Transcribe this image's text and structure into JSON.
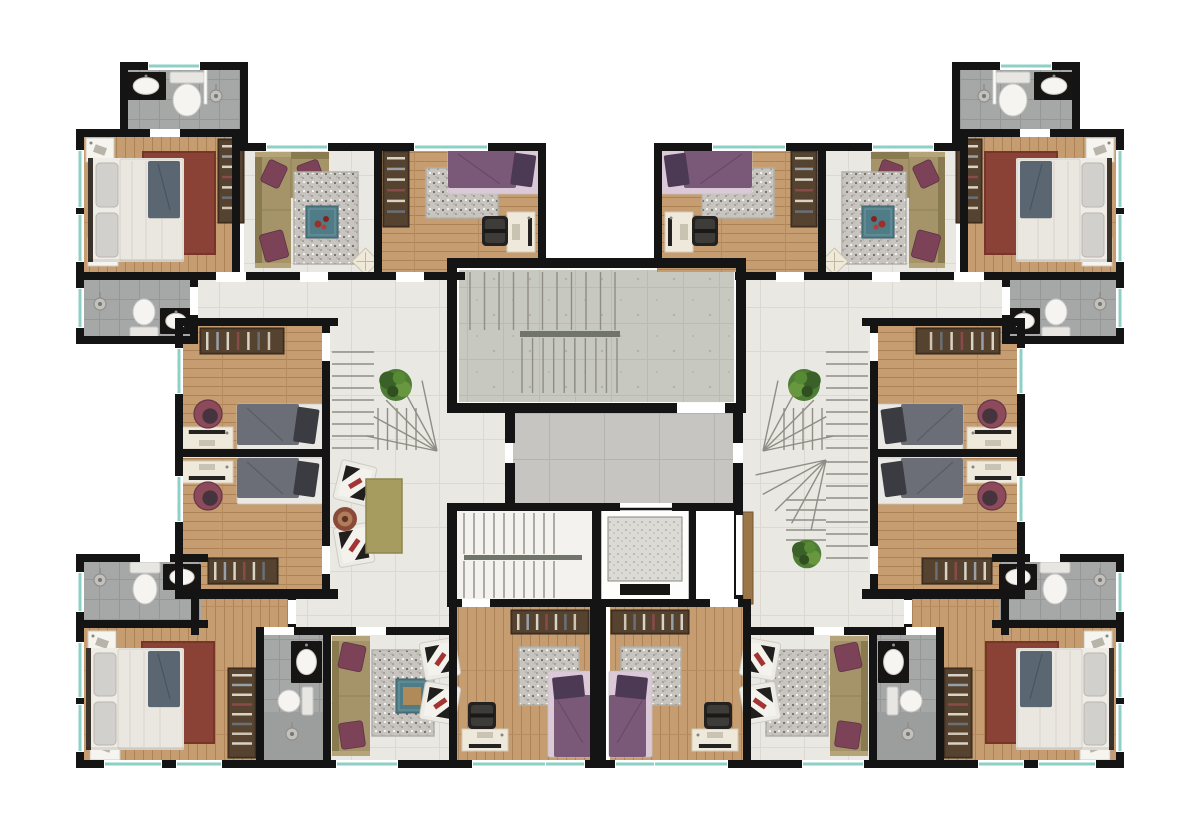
{
  "meta": {
    "label": "Residential apartment building floor plan, top view, symmetric left and right wings with central stairwell and elevator"
  },
  "palette": {
    "wall": "#141414",
    "gap": "#ffffff",
    "teal": "#8fd0c6",
    "stairLine": "#8f8d84",
    "rail": "#70746a",
    "headboard": "#3a332b",
    "sofa": "#a5946a",
    "sofaDark": "#8a7a4f",
    "cushion": "#7c4257",
    "rugRed": "#8a4136",
    "rugRedEdge": "#763528",
    "rugGreen": "#a69c60",
    "rugGrayEdge": "#b2afa8",
    "wardrobe": "#4d3b2c",
    "desk": "#efe9dc",
    "fixture": "#f5f4f1"
  },
  "floors": [
    {
      "n": "hall-left",
      "x": 183,
      "y": 272,
      "w": 274,
      "h": 328,
      "p": "tile",
      "m": 1
    },
    {
      "n": "hall-lobby-side",
      "x": 457,
      "y": 408,
      "w": 48,
      "h": 95,
      "p": "tile",
      "m": 0
    },
    {
      "n": "hall-bottom",
      "x": 285,
      "y": 595,
      "w": 172,
      "h": 40,
      "p": "tile",
      "m": 1
    },
    {
      "n": "living-top",
      "x": 244,
      "y": 149,
      "w": 136,
      "h": 123,
      "p": "tile",
      "m": 1
    },
    {
      "n": "living-bottom",
      "x": 288,
      "y": 635,
      "w": 161,
      "h": 127,
      "p": "tile",
      "m": 1
    },
    {
      "n": "entry-nook",
      "x": 199,
      "y": 597,
      "w": 89,
      "h": 30,
      "p": "woodV",
      "m": 1
    },
    {
      "n": "master-bedroom-top",
      "x": 82,
      "y": 133,
      "w": 156,
      "h": 139,
      "p": "woodV",
      "m": 1
    },
    {
      "n": "bedroom-top",
      "x": 382,
      "y": 147,
      "w": 161,
      "h": 125,
      "p": "woodH",
      "m": 1
    },
    {
      "n": "bedroom-mid-upper",
      "x": 183,
      "y": 326,
      "w": 140,
      "h": 126,
      "p": "woodH",
      "m": 1
    },
    {
      "n": "bedroom-mid-lower",
      "x": 183,
      "y": 458,
      "w": 140,
      "h": 133,
      "p": "woodH",
      "m": 1
    },
    {
      "n": "master-bedroom-bottom",
      "x": 84,
      "y": 627,
      "w": 176,
      "h": 135,
      "p": "woodV",
      "m": 1
    },
    {
      "n": "bedroom-bottom",
      "x": 457,
      "y": 607,
      "w": 133,
      "h": 155,
      "p": "woodV",
      "m": 1
    },
    {
      "n": "bathroom-top",
      "x": 128,
      "y": 70,
      "w": 112,
      "h": 61,
      "p": "bath",
      "m": 1
    },
    {
      "n": "bathroom-mid",
      "x": 84,
      "y": 280,
      "w": 106,
      "h": 58,
      "p": "bath",
      "m": 1
    },
    {
      "n": "bathroom-lower",
      "x": 84,
      "y": 562,
      "w": 117,
      "h": 58,
      "p": "bath",
      "m": 1
    },
    {
      "n": "bathroom-small",
      "x": 264,
      "y": 635,
      "w": 59,
      "h": 125,
      "p": "bath",
      "m": 1
    },
    {
      "n": "shower-floor",
      "x": 264,
      "y": 712,
      "w": 59,
      "h": 48,
      "f": "#9c9e9d",
      "m": 1
    },
    {
      "n": "stairwell-trim",
      "x": 452,
      "y": 263,
      "w": 289,
      "h": 146,
      "f": "#fbfbf9",
      "m": 0
    },
    {
      "n": "stairwell-concrete",
      "x": 459,
      "y": 270,
      "w": 275,
      "h": 132,
      "p": "conc",
      "m": 0
    },
    {
      "n": "elevator-lobby",
      "x": 513,
      "y": 411,
      "w": 220,
      "h": 92,
      "p": "lobbyP",
      "m": 0
    },
    {
      "n": "stair-core-floor",
      "x": 457,
      "y": 511,
      "w": 135,
      "h": 88,
      "f": "#f3f2ee",
      "m": 0
    }
  ],
  "walls": [
    [
      120,
      62,
      128,
      8,
      1
    ],
    [
      120,
      62,
      8,
      75,
      1
    ],
    [
      240,
      62,
      8,
      89,
      1
    ],
    [
      76,
      129,
      172,
      8,
      1
    ],
    [
      76,
      129,
      8,
      212,
      1
    ],
    [
      232,
      133,
      8,
      144,
      1
    ],
    [
      240,
      143,
      306,
      8,
      1
    ],
    [
      538,
      143,
      8,
      125,
      1
    ],
    [
      76,
      272,
      389,
      8,
      1
    ],
    [
      374,
      149,
      8,
      131,
      1
    ],
    [
      76,
      336,
      122,
      8,
      1
    ],
    [
      190,
      277,
      8,
      67,
      1
    ],
    [
      175,
      318,
      163,
      8,
      1
    ],
    [
      175,
      318,
      8,
      281,
      1
    ],
    [
      322,
      318,
      8,
      281,
      1
    ],
    [
      175,
      449,
      155,
      8,
      1
    ],
    [
      175,
      589,
      163,
      10,
      1
    ],
    [
      191,
      597,
      8,
      38,
      1
    ],
    [
      288,
      597,
      8,
      38,
      1
    ],
    [
      76,
      554,
      132,
      8,
      1
    ],
    [
      76,
      554,
      8,
      214,
      1
    ],
    [
      76,
      620,
      132,
      8,
      1
    ],
    [
      76,
      760,
      380,
      8,
      1
    ],
    [
      256,
      627,
      8,
      141,
      1
    ],
    [
      285,
      627,
      172,
      8,
      1
    ],
    [
      323,
      627,
      8,
      135,
      1
    ],
    [
      449,
      599,
      8,
      169,
      1
    ],
    [
      449,
      599,
      148,
      8,
      1
    ],
    [
      447,
      258,
      299,
      10,
      0
    ],
    [
      447,
      258,
      10,
      155,
      0
    ],
    [
      736,
      258,
      10,
      155,
      0
    ],
    [
      447,
      403,
      230,
      10,
      0
    ],
    [
      725,
      403,
      21,
      10,
      0
    ],
    [
      505,
      413,
      10,
      30,
      0
    ],
    [
      505,
      463,
      10,
      42,
      0
    ],
    [
      733,
      413,
      10,
      30,
      0
    ],
    [
      733,
      463,
      10,
      42,
      0
    ],
    [
      592,
      503,
      8,
      104,
      0
    ],
    [
      600,
      503,
      20,
      8,
      0
    ],
    [
      672,
      503,
      63,
      8,
      0
    ],
    [
      735,
      503,
      8,
      12,
      0
    ],
    [
      735,
      595,
      8,
      12,
      0
    ],
    [
      592,
      599,
      151,
      8,
      0
    ],
    [
      690,
      509,
      5,
      92,
      0
    ],
    [
      447,
      503,
      10,
      104,
      0
    ],
    [
      447,
      503,
      145,
      8,
      0
    ],
    [
      590,
      599,
      16,
      169,
      0
    ],
    [
      449,
      760,
      302,
      8,
      0
    ]
  ],
  "gaps": [
    [
      150,
      129,
      30,
      8,
      1
    ],
    [
      216,
      272,
      30,
      10,
      1
    ],
    [
      300,
      272,
      28,
      10,
      1
    ],
    [
      396,
      272,
      28,
      10,
      1
    ],
    [
      190,
      287,
      8,
      28,
      1
    ],
    [
      322,
      333,
      8,
      28,
      1
    ],
    [
      322,
      546,
      8,
      28,
      1
    ],
    [
      140,
      554,
      30,
      8,
      1
    ],
    [
      268,
      627,
      26,
      8,
      1
    ],
    [
      356,
      627,
      30,
      8,
      1
    ],
    [
      462,
      599,
      28,
      8,
      1
    ],
    [
      288,
      600,
      8,
      24,
      1
    ],
    [
      677,
      403,
      48,
      10,
      0
    ]
  ],
  "windows": [
    [
      148,
      62,
      52,
      8,
      1
    ],
    [
      76,
      150,
      8,
      58,
      1
    ],
    [
      76,
      214,
      8,
      48,
      1
    ],
    [
      76,
      288,
      8,
      40,
      1
    ],
    [
      175,
      348,
      8,
      46,
      1
    ],
    [
      175,
      476,
      8,
      46,
      1
    ],
    [
      76,
      572,
      8,
      40,
      1
    ],
    [
      76,
      642,
      8,
      56,
      1
    ],
    [
      76,
      704,
      8,
      48,
      1
    ],
    [
      104,
      760,
      58,
      8,
      1
    ],
    [
      176,
      760,
      46,
      8,
      1
    ],
    [
      336,
      760,
      62,
      8,
      1
    ],
    [
      472,
      760,
      74,
      8,
      1
    ],
    [
      545,
      760,
      40,
      8,
      1
    ],
    [
      266,
      143,
      62,
      8,
      1
    ],
    [
      414,
      143,
      74,
      8,
      1
    ]
  ],
  "stairs": [
    {
      "t": "run",
      "x": 470,
      "y": 272,
      "w": 145,
      "h": 58,
      "dir": "v",
      "n": 10,
      "m": 0
    },
    {
      "t": "rail",
      "x": 520,
      "y": 331,
      "w": 100,
      "h": 6,
      "m": 0
    },
    {
      "t": "run",
      "x": 522,
      "y": 338,
      "w": 95,
      "h": 55,
      "dir": "v",
      "n": 9,
      "m": 0
    },
    {
      "t": "run",
      "x": 464,
      "y": 513,
      "w": 90,
      "h": 41,
      "dir": "v",
      "n": 9,
      "m": 0
    },
    {
      "t": "rail",
      "x": 464,
      "y": 555,
      "w": 118,
      "h": 5,
      "m": 0
    },
    {
      "t": "run",
      "x": 464,
      "y": 561,
      "w": 90,
      "h": 37,
      "dir": "v",
      "n": 9,
      "m": 0
    },
    {
      "t": "run",
      "x": 332,
      "y": 352,
      "w": 42,
      "h": 96,
      "dir": "h",
      "n": 8,
      "m": 1
    },
    {
      "t": "fan",
      "px": 437,
      "py": 451,
      "r": 72,
      "a0": 192,
      "a1": 258,
      "n": 5,
      "m": 1
    },
    {
      "t": "run",
      "x": 378,
      "y": 408,
      "w": 38,
      "h": 42,
      "dir": "v",
      "n": 4,
      "m": 1
    },
    {
      "t": "run",
      "x": 826,
      "y": 462,
      "w": 42,
      "h": 96,
      "dir": "h",
      "n": 8,
      "m": 0
    },
    {
      "t": "fan",
      "px": 826,
      "py": 460,
      "r": 72,
      "a0": 102,
      "a1": 168,
      "n": 5,
      "m": 0
    },
    {
      "t": "run",
      "x": 786,
      "y": 500,
      "w": 40,
      "h": 40,
      "dir": "h",
      "n": 4,
      "m": 0
    }
  ],
  "items": [
    {
      "t": "sink",
      "x": 126,
      "y": 72,
      "w": 40,
      "h": 28,
      "m": 1
    },
    {
      "t": "toilet",
      "x": 170,
      "y": 72,
      "w": 34,
      "h": 46,
      "dir": "n",
      "m": 1
    },
    {
      "t": "glass",
      "x": 204,
      "y": 66,
      "w": 3,
      "h": 38,
      "m": 1
    },
    {
      "t": "shower",
      "x": 216,
      "y": 96,
      "m": 1
    },
    {
      "t": "nightstand",
      "x": 86,
      "y": 138,
      "w": 28,
      "h": 24,
      "m": 1
    },
    {
      "t": "nightstand",
      "x": 88,
      "y": 238,
      "w": 30,
      "h": 28,
      "m": 1
    },
    {
      "t": "rug",
      "x": 143,
      "y": 152,
      "w": 72,
      "h": 102,
      "v": "red",
      "m": 1
    },
    {
      "t": "bed_double",
      "x": 88,
      "y": 158,
      "w": 96,
      "h": 104,
      "m": 1
    },
    {
      "t": "wardrobe",
      "x": 218,
      "y": 139,
      "w": 26,
      "h": 84,
      "m": 1
    },
    {
      "t": "sofa_l",
      "x": 255,
      "y": 152,
      "w": 36,
      "h": 116,
      "cw": 38,
      "ch": 46,
      "m": 1
    },
    {
      "t": "rug",
      "x": 294,
      "y": 172,
      "w": 64,
      "h": 92,
      "v": "gray",
      "m": 1
    },
    {
      "t": "table",
      "x": 306,
      "y": 206,
      "w": 32,
      "h": 32,
      "v": "red",
      "m": 1
    },
    {
      "t": "pouf",
      "x": 356,
      "y": 252,
      "w": 19,
      "h": 19,
      "m": 1
    },
    {
      "t": "wardrobe",
      "x": 383,
      "y": 151,
      "w": 26,
      "h": 76,
      "m": 1
    },
    {
      "t": "rug",
      "x": 426,
      "y": 168,
      "w": 72,
      "h": 50,
      "v": "gray",
      "m": 1
    },
    {
      "t": "bed_single",
      "x": 448,
      "y": 150,
      "w": 92,
      "h": 44,
      "head": "e",
      "v": "purple",
      "m": 1
    },
    {
      "t": "desk",
      "x": 507,
      "y": 212,
      "w": 28,
      "h": 40,
      "side": "e",
      "m": 1
    },
    {
      "t": "chair",
      "x": 482,
      "y": 216,
      "w": 26,
      "h": 30,
      "m": 1
    },
    {
      "t": "shower",
      "x": 100,
      "y": 304,
      "m": 1
    },
    {
      "t": "toilet",
      "x": 130,
      "y": 298,
      "w": 28,
      "h": 40,
      "dir": "s",
      "m": 1
    },
    {
      "t": "sink",
      "x": 160,
      "y": 308,
      "w": 32,
      "h": 26,
      "m": 1
    },
    {
      "t": "wardrobe",
      "x": 200,
      "y": 328,
      "w": 84,
      "h": 26,
      "m": 1
    },
    {
      "t": "bed_single",
      "x": 237,
      "y": 404,
      "w": 86,
      "h": 47,
      "head": "e",
      "v": "gray",
      "m": 1
    },
    {
      "t": "desk",
      "x": 181,
      "y": 427,
      "w": 52,
      "h": 22,
      "side": "n",
      "m": 1
    },
    {
      "t": "chair_round",
      "x": 194,
      "y": 400,
      "w": 28,
      "h": 28,
      "m": 1
    },
    {
      "t": "desk",
      "x": 181,
      "y": 461,
      "w": 52,
      "h": 22,
      "side": "s",
      "m": 1
    },
    {
      "t": "chair_round",
      "x": 194,
      "y": 482,
      "w": 28,
      "h": 28,
      "m": 1
    },
    {
      "t": "bed_single",
      "x": 237,
      "y": 458,
      "w": 86,
      "h": 46,
      "head": "e",
      "v": "gray",
      "m": 1
    },
    {
      "t": "wardrobe",
      "x": 208,
      "y": 558,
      "w": 70,
      "h": 26,
      "m": 1
    },
    {
      "t": "plant",
      "x": 377,
      "y": 367,
      "w": 38,
      "h": 36,
      "m": 1
    },
    {
      "t": "armchair",
      "x": 337,
      "y": 463,
      "w": 36,
      "h": 40,
      "rot": 14,
      "m": 0
    },
    {
      "t": "armchair",
      "x": 336,
      "y": 525,
      "w": 36,
      "h": 40,
      "rot": -10,
      "m": 0
    },
    {
      "t": "rug",
      "x": 366,
      "y": 479,
      "w": 36,
      "h": 74,
      "v": "green",
      "m": 0
    },
    {
      "t": "round_rug",
      "x": 333,
      "y": 507,
      "w": 24,
      "h": 24,
      "m": 0
    },
    {
      "t": "shower",
      "x": 100,
      "y": 580,
      "m": 1
    },
    {
      "t": "toilet",
      "x": 130,
      "y": 562,
      "w": 30,
      "h": 44,
      "dir": "n",
      "m": 1
    },
    {
      "t": "sink",
      "x": 163,
      "y": 564,
      "w": 38,
      "h": 26,
      "m": 1
    },
    {
      "t": "nightstand",
      "x": 88,
      "y": 631,
      "w": 28,
      "h": 24,
      "m": 1
    },
    {
      "t": "nightstand",
      "x": 90,
      "y": 734,
      "w": 30,
      "h": 26,
      "m": 1
    },
    {
      "t": "rug",
      "x": 142,
      "y": 642,
      "w": 72,
      "h": 101,
      "v": "red",
      "m": 1
    },
    {
      "t": "bed_double",
      "x": 86,
      "y": 648,
      "w": 98,
      "h": 102,
      "m": 1
    },
    {
      "t": "wardrobe",
      "x": 228,
      "y": 668,
      "w": 28,
      "h": 90,
      "m": 1
    },
    {
      "t": "sink",
      "x": 291,
      "y": 641,
      "w": 31,
      "h": 42,
      "m": 1
    },
    {
      "t": "toilet",
      "x": 277,
      "y": 687,
      "w": 36,
      "h": 28,
      "dir": "e",
      "m": 1
    },
    {
      "t": "shower",
      "x": 292,
      "y": 734,
      "m": 1
    },
    {
      "t": "sofa",
      "x": 332,
      "y": 636,
      "w": 38,
      "h": 120,
      "m": 1
    },
    {
      "t": "rug",
      "x": 372,
      "y": 650,
      "w": 62,
      "h": 86,
      "v": "gray",
      "m": 1
    },
    {
      "t": "table",
      "x": 396,
      "y": 679,
      "w": 32,
      "h": 34,
      "v": "wood",
      "m": 0
    },
    {
      "t": "armchair",
      "x": 422,
      "y": 640,
      "w": 36,
      "h": 38,
      "rot": -10,
      "m": 1
    },
    {
      "t": "armchair",
      "x": 422,
      "y": 684,
      "w": 36,
      "h": 38,
      "rot": 10,
      "m": 1
    },
    {
      "t": "diamond",
      "x": 820,
      "y": 672,
      "w": 17,
      "h": 17,
      "m": 0
    },
    {
      "t": "wardrobe",
      "x": 511,
      "y": 610,
      "w": 78,
      "h": 24,
      "m": 1
    },
    {
      "t": "rug",
      "x": 519,
      "y": 647,
      "w": 60,
      "h": 58,
      "v": "gray",
      "m": 1
    },
    {
      "t": "bed_single",
      "x": 548,
      "y": 671,
      "w": 43,
      "h": 86,
      "head": "n",
      "v": "purple",
      "m": 1
    },
    {
      "t": "desk",
      "x": 462,
      "y": 729,
      "w": 46,
      "h": 22,
      "side": "s",
      "m": 1
    },
    {
      "t": "chair",
      "x": 468,
      "y": 702,
      "w": 28,
      "h": 27,
      "m": 1
    },
    {
      "t": "elevator",
      "x": 600,
      "y": 509,
      "w": 90,
      "h": 94,
      "m": 0
    },
    {
      "t": "duct",
      "x": 695,
      "y": 509,
      "w": 40,
      "h": 94,
      "m": 0
    },
    {
      "t": "wood_strip",
      "x": 743,
      "y": 512,
      "w": 10,
      "h": 92,
      "m": 0
    },
    {
      "t": "plant",
      "x": 790,
      "y": 538,
      "w": 34,
      "h": 32,
      "m": 0
    }
  ]
}
